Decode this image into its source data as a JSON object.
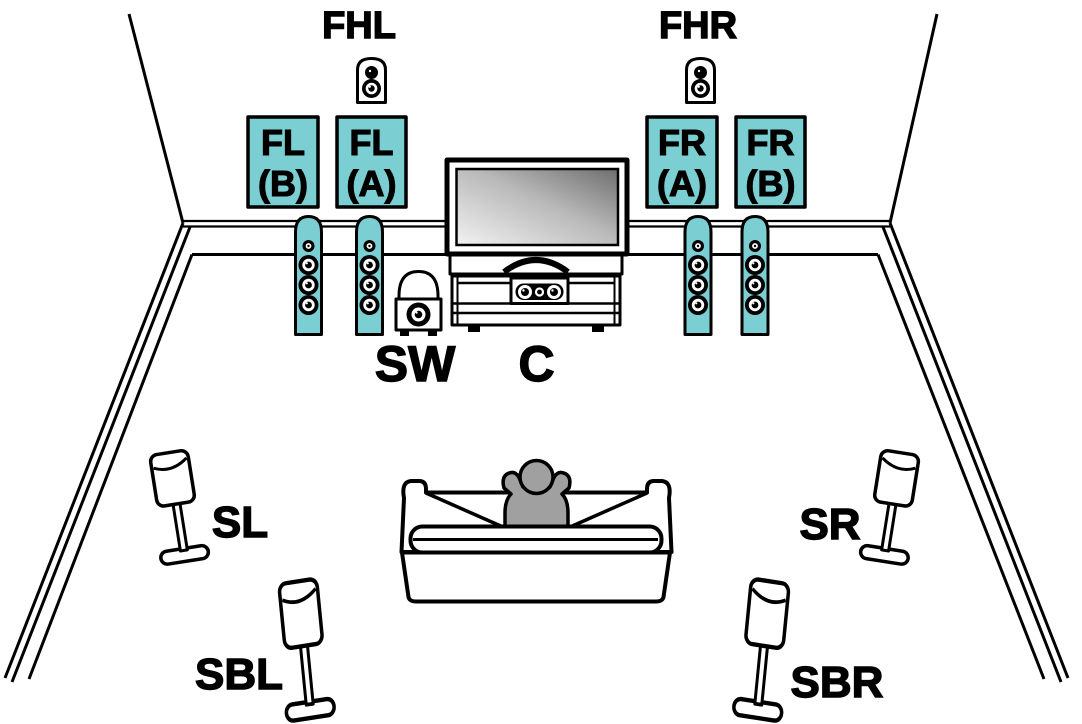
{
  "colors": {
    "highlight": "#7BCED2",
    "person": "#A0A0A0",
    "outline": "#000000",
    "background": "#FFFFFF"
  },
  "labels": {
    "fhl": "FHL",
    "fhr": "FHR",
    "sw": "SW",
    "c": "C",
    "sl": "SL",
    "sr": "SR",
    "sbl": "SBL",
    "sbr": "SBR",
    "fl_b": {
      "l1": "FL",
      "l2": "(B)"
    },
    "fl_a": {
      "l1": "FL",
      "l2": "(A)"
    },
    "fr_a": {
      "l1": "FR",
      "l2": "(A)"
    },
    "fr_b": {
      "l1": "FR",
      "l2": "(B)"
    }
  }
}
